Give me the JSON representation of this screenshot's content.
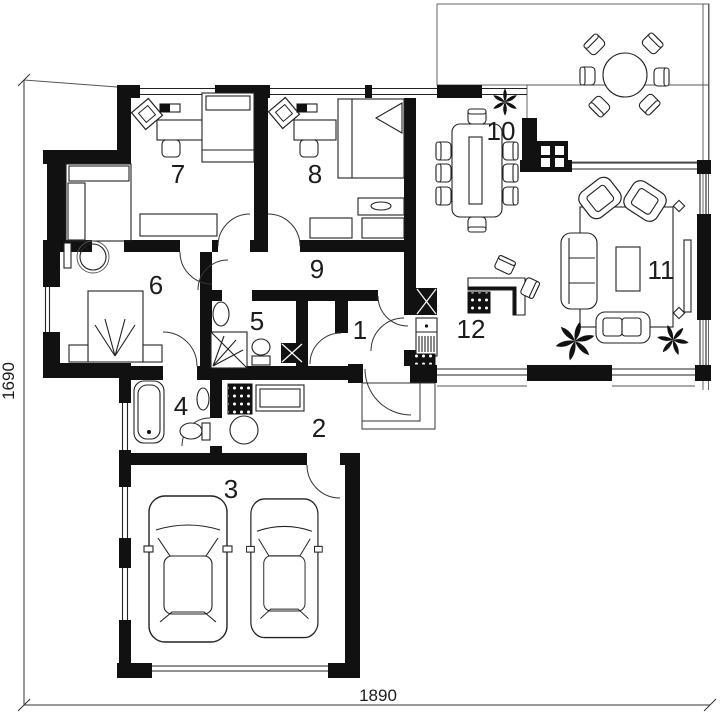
{
  "colors": {
    "accent_bar": "#4d6b71",
    "wall": "#111111",
    "line": "#222222",
    "background": "#ffffff"
  },
  "dimension_labels": {
    "bottom": "1890",
    "left": "1690"
  },
  "room_labels": [
    {
      "number": "1"
    },
    {
      "number": "2"
    },
    {
      "number": "3"
    },
    {
      "number": "4"
    },
    {
      "number": "5"
    },
    {
      "number": "6"
    },
    {
      "number": "7"
    },
    {
      "number": "8"
    },
    {
      "number": "9"
    },
    {
      "number": "10"
    },
    {
      "number": "11"
    },
    {
      "number": "12"
    }
  ],
  "furniture_symbols": [
    "double-bed",
    "single-bed",
    "wardrobe",
    "walk-in-closet-rails",
    "desk",
    "chair",
    "lounge-chair",
    "sofa",
    "armchair",
    "coffee-table",
    "tv-panel",
    "rug",
    "dining-table",
    "dining-chair",
    "round-terrace-table",
    "terrace-chair",
    "bathtub",
    "shower",
    "toilet",
    "washbasin",
    "stove",
    "counter",
    "boiler",
    "car",
    "plant",
    "fireplace",
    "ventilation-shaft",
    "doormat",
    "keyboard",
    "deck-boards"
  ]
}
